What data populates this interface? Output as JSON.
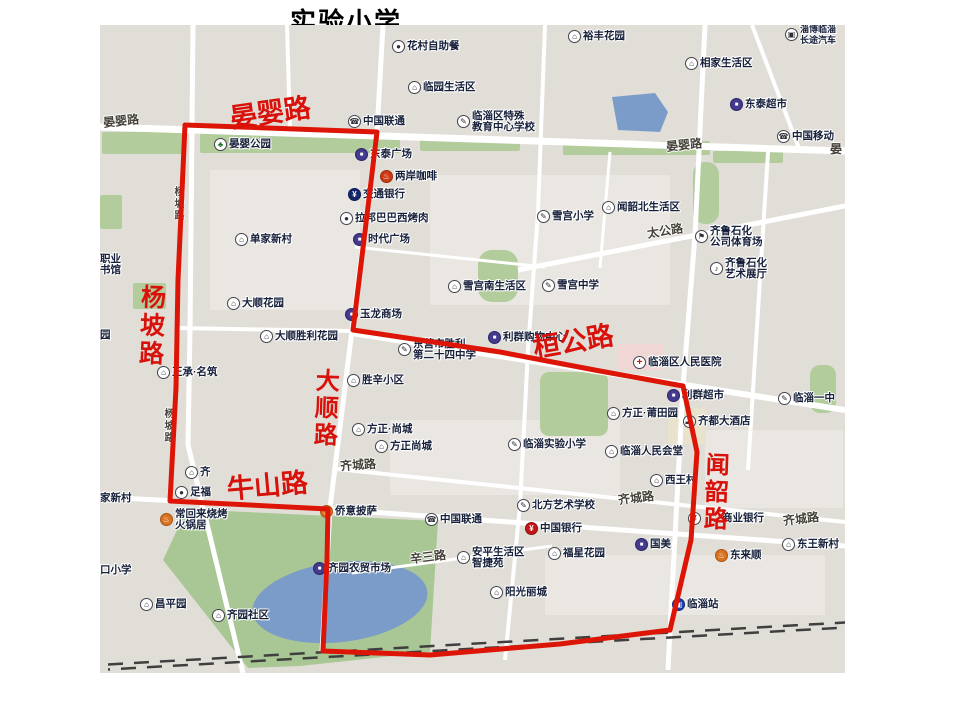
{
  "title": "实验小学",
  "colors": {
    "map_bg": "#e1ded8",
    "block_light": "#eae7e2",
    "road": "#ffffff",
    "green": "#b3cc9c",
    "park_green": "#a9c794",
    "pond_blue": "#7b9cc9",
    "boundary_red": "#dd1506",
    "railway": "#3f3f3f",
    "hospital_block_pink": "#f0d6d4",
    "hotel_block_tan": "#e9e2cd"
  },
  "map": {
    "blocks": [
      {
        "x": 210,
        "y": 170,
        "w": 150,
        "h": 140
      },
      {
        "x": 430,
        "y": 175,
        "w": 240,
        "h": 130
      },
      {
        "x": 390,
        "y": 420,
        "w": 230,
        "h": 75
      },
      {
        "x": 545,
        "y": 555,
        "w": 280,
        "h": 60
      },
      {
        "x": 705,
        "y": 430,
        "w": 138,
        "h": 78
      },
      {
        "x": 618,
        "y": 344,
        "w": 46,
        "h": 26,
        "c": "#f0d6d4"
      },
      {
        "x": 668,
        "y": 408,
        "w": 38,
        "h": 36,
        "c": "#e9e2cd"
      }
    ],
    "greens": [
      {
        "x": 102,
        "y": 132,
        "w": 80,
        "h": 22
      },
      {
        "x": 200,
        "y": 133,
        "w": 200,
        "h": 20
      },
      {
        "x": 420,
        "y": 137,
        "w": 100,
        "h": 14
      },
      {
        "x": 563,
        "y": 141,
        "w": 147,
        "h": 14
      },
      {
        "x": 713,
        "y": 151,
        "w": 70,
        "h": 12
      },
      {
        "x": 693,
        "y": 162,
        "w": 26,
        "h": 62,
        "r": 12
      },
      {
        "x": 478,
        "y": 250,
        "w": 40,
        "h": 52,
        "r": 14
      },
      {
        "x": 540,
        "y": 372,
        "w": 68,
        "h": 64,
        "r": 9
      },
      {
        "x": 810,
        "y": 365,
        "w": 26,
        "h": 48,
        "r": 10
      },
      {
        "x": 100,
        "y": 195,
        "w": 22,
        "h": 34
      },
      {
        "x": 133,
        "y": 283,
        "w": 33,
        "h": 26
      }
    ],
    "park_polygon": [
      [
        203,
        510
      ],
      [
        438,
        521
      ],
      [
        430,
        652
      ],
      [
        300,
        666
      ],
      [
        248,
        668
      ],
      [
        163,
        560
      ],
      [
        185,
        513
      ]
    ],
    "pond": {
      "cx": 340,
      "cy": 602,
      "rx": 88,
      "ry": 40,
      "rot": -7
    },
    "top_pond": [
      [
        612,
        97
      ],
      [
        655,
        93
      ],
      [
        668,
        112
      ],
      [
        660,
        132
      ],
      [
        618,
        130
      ]
    ],
    "roads": [
      {
        "w": 7,
        "pts": [
          [
            100,
            127
          ],
          [
            845,
            151
          ]
        ]
      },
      {
        "w": 4,
        "pts": [
          [
            287,
            25
          ],
          [
            290,
            129
          ]
        ]
      },
      {
        "w": 5,
        "pts": [
          [
            193,
            25
          ],
          [
            190,
            330
          ],
          [
            188,
            445
          ],
          [
            243,
            673
          ]
        ]
      },
      {
        "w": 5,
        "pts": [
          [
            383,
            25
          ],
          [
            377,
            132
          ],
          [
            352,
            330
          ],
          [
            330,
            508
          ],
          [
            322,
            652
          ]
        ]
      },
      {
        "w": 4,
        "pts": [
          [
            545,
            25
          ],
          [
            538,
            212
          ],
          [
            528,
            350
          ],
          [
            520,
            505
          ],
          [
            505,
            660
          ]
        ]
      },
      {
        "w": 5,
        "pts": [
          [
            705,
            25
          ],
          [
            695,
            235
          ],
          [
            683,
            387
          ],
          [
            670,
            630
          ],
          [
            668,
            670
          ]
        ]
      },
      {
        "w": 4,
        "pts": [
          [
            752,
            25
          ],
          [
            800,
            151
          ]
        ]
      },
      {
        "w": 5,
        "pts": [
          [
            518,
            270
          ],
          [
            845,
            206
          ]
        ]
      },
      {
        "w": 4,
        "pts": [
          [
            176,
            328
          ],
          [
            352,
            331
          ]
        ]
      },
      {
        "w": 6,
        "pts": [
          [
            352,
            333
          ],
          [
            845,
            410
          ]
        ]
      },
      {
        "w": 4,
        "pts": [
          [
            337,
            469
          ],
          [
            845,
            522
          ]
        ]
      },
      {
        "w": 5,
        "pts": [
          [
            100,
            497
          ],
          [
            328,
            509
          ],
          [
            845,
            546
          ]
        ]
      },
      {
        "w": 3,
        "pts": [
          [
            352,
            573
          ],
          [
            552,
            546
          ]
        ]
      },
      {
        "w": 3,
        "pts": [
          [
            355,
            247
          ],
          [
            545,
            267
          ]
        ]
      },
      {
        "w": 4,
        "pts": [
          [
            768,
            152
          ],
          [
            748,
            470
          ]
        ]
      },
      {
        "w": 3,
        "pts": [
          [
            610,
            152
          ],
          [
            600,
            268
          ]
        ]
      }
    ],
    "railway": [
      [
        108,
        667
      ],
      [
        845,
        625
      ]
    ],
    "boundary": [
      [
        185,
        125
      ],
      [
        377,
        132
      ],
      [
        363,
        248
      ],
      [
        353,
        330
      ],
      [
        500,
        352
      ],
      [
        600,
        371
      ],
      [
        683,
        386
      ],
      [
        697,
        452
      ],
      [
        691,
        540
      ],
      [
        670,
        630
      ],
      [
        560,
        644
      ],
      [
        430,
        655
      ],
      [
        323,
        651
      ],
      [
        327,
        560
      ],
      [
        328,
        509
      ],
      [
        170,
        501
      ],
      [
        176,
        388
      ],
      [
        178,
        280
      ],
      [
        185,
        125
      ]
    ]
  },
  "red_road_labels": [
    {
      "text": "晏婴路",
      "x": 230,
      "y": 98,
      "size": 27,
      "rot": -8,
      "vert": false
    },
    {
      "text": "杨坡路",
      "x": 136,
      "y": 284,
      "size": 25,
      "rot": 2,
      "vert": true
    },
    {
      "text": "大顺路",
      "x": 310,
      "y": 368,
      "size": 24,
      "rot": 2,
      "vert": true
    },
    {
      "text": "牛山路",
      "x": 227,
      "y": 471,
      "size": 27,
      "rot": -5,
      "vert": false
    },
    {
      "text": "桓公路",
      "x": 533,
      "y": 327,
      "size": 27,
      "rot": -10,
      "vert": false
    },
    {
      "text": "闻韶路",
      "x": 700,
      "y": 452,
      "size": 24,
      "rot": 2,
      "vert": true
    }
  ],
  "black_road_labels": [
    {
      "text": "晏婴路",
      "x": 103,
      "y": 112,
      "size": 12,
      "rot": -6
    },
    {
      "text": "晏婴路",
      "x": 666,
      "y": 136,
      "size": 12,
      "rot": -6
    },
    {
      "text": "晏",
      "x": 830,
      "y": 140,
      "size": 12,
      "rot": 0
    },
    {
      "text": "杨坡路",
      "x": 170,
      "y": 186,
      "size": 10,
      "rot": 0,
      "vert": true
    },
    {
      "text": "杨坡路",
      "x": 160,
      "y": 408,
      "size": 10,
      "rot": 0,
      "vert": true
    },
    {
      "text": "太公路",
      "x": 647,
      "y": 222,
      "size": 12,
      "rot": -9
    },
    {
      "text": "齐城路",
      "x": 340,
      "y": 456,
      "size": 12,
      "rot": -4
    },
    {
      "text": "齐城路",
      "x": 618,
      "y": 489,
      "size": 12,
      "rot": -7
    },
    {
      "text": "齐城路",
      "x": 783,
      "y": 510,
      "size": 12,
      "rot": -7
    },
    {
      "text": "辛三路",
      "x": 410,
      "y": 548,
      "size": 12,
      "rot": -7
    }
  ],
  "pois": [
    {
      "icon": "dot",
      "lines": [
        "花村自助餐"
      ],
      "x": 392,
      "y": 40
    },
    {
      "icon": "estate",
      "lines": [
        "裕丰花园"
      ],
      "x": 568,
      "y": 30
    },
    {
      "icon": "bus",
      "lines": [
        "淄博临淄",
        "长途汽车"
      ],
      "x": 785,
      "y": 28,
      "small": true
    },
    {
      "icon": "estate",
      "lines": [
        "相家生活区"
      ],
      "x": 685,
      "y": 57
    },
    {
      "icon": "estate",
      "lines": [
        "临园生活区"
      ],
      "x": 408,
      "y": 81
    },
    {
      "icon": "mall",
      "lines": [
        "东泰超市"
      ],
      "x": 730,
      "y": 98
    },
    {
      "icon": "telecom",
      "lines": [
        "中国联通"
      ],
      "x": 348,
      "y": 115
    },
    {
      "icon": "school",
      "lines": [
        "临淄区特殊",
        "教育中心学校"
      ],
      "x": 457,
      "y": 115
    },
    {
      "icon": "telecom",
      "lines": [
        "中国移动"
      ],
      "x": 777,
      "y": 130
    },
    {
      "icon": "park",
      "lines": [
        "晏婴公园"
      ],
      "x": 214,
      "y": 138
    },
    {
      "icon": "mall",
      "lines": [
        "东泰广场"
      ],
      "x": 355,
      "y": 148
    },
    {
      "icon": "coffee",
      "lines": [
        "两岸咖啡"
      ],
      "x": 380,
      "y": 170
    },
    {
      "icon": "bank",
      "lines": [
        "交通银行"
      ],
      "x": 348,
      "y": 188
    },
    {
      "icon": "dot",
      "lines": [
        "拉邦巴巴西烤肉"
      ],
      "x": 340,
      "y": 212
    },
    {
      "icon": "mall",
      "lines": [
        "时代广场"
      ],
      "x": 353,
      "y": 233
    },
    {
      "icon": "school",
      "lines": [
        "雪宫小学"
      ],
      "x": 537,
      "y": 210
    },
    {
      "icon": "estate",
      "lines": [
        "闻韶北生活区"
      ],
      "x": 602,
      "y": 201
    },
    {
      "icon": "estate",
      "lines": [
        "单家新村"
      ],
      "x": 235,
      "y": 233
    },
    {
      "icon": "stadium",
      "lines": [
        "齐鲁石化",
        "公司体育场"
      ],
      "x": 695,
      "y": 230
    },
    {
      "icon": "art",
      "lines": [
        "齐鲁石化",
        "艺术展厅"
      ],
      "x": 710,
      "y": 262
    },
    {
      "icon": "estate",
      "lines": [
        "大顺花园"
      ],
      "x": 227,
      "y": 297
    },
    {
      "icon": "estate",
      "lines": [
        "雪宫南生活区"
      ],
      "x": 448,
      "y": 280
    },
    {
      "icon": "school",
      "lines": [
        "雪宫中学"
      ],
      "x": 542,
      "y": 279
    },
    {
      "icon": "mall",
      "lines": [
        "玉龙商场"
      ],
      "x": 345,
      "y": 308
    },
    {
      "icon": "estate",
      "lines": [
        "大顺胜利花园"
      ],
      "x": 260,
      "y": 330
    },
    {
      "icon": "estate",
      "lines": [
        "正承·名筑"
      ],
      "x": 157,
      "y": 366
    },
    {
      "icon": "school",
      "lines": [
        "东营市胜利",
        "第二十四中学"
      ],
      "x": 398,
      "y": 343
    },
    {
      "icon": "mall",
      "lines": [
        "利群购物中心"
      ],
      "x": 488,
      "y": 331
    },
    {
      "icon": "hospital",
      "lines": [
        "临淄区人民医院"
      ],
      "x": 633,
      "y": 356
    },
    {
      "icon": "estate",
      "lines": [
        "胜辛小区"
      ],
      "x": 347,
      "y": 374
    },
    {
      "icon": "mall",
      "lines": [
        "利群超市"
      ],
      "x": 667,
      "y": 389
    },
    {
      "icon": "school",
      "lines": [
        "临淄一中"
      ],
      "x": 778,
      "y": 392
    },
    {
      "icon": "estate",
      "lines": [
        "方正·尚城"
      ],
      "x": 352,
      "y": 423
    },
    {
      "icon": "estate",
      "lines": [
        "方正·莆田园"
      ],
      "x": 607,
      "y": 407
    },
    {
      "icon": "hotel",
      "lines": [
        "齐都大酒店"
      ],
      "x": 683,
      "y": 415
    },
    {
      "icon": "estate",
      "lines": [
        "方正尚城"
      ],
      "x": 375,
      "y": 440
    },
    {
      "icon": "school",
      "lines": [
        "临淄实验小学"
      ],
      "x": 508,
      "y": 438
    },
    {
      "icon": "hall",
      "lines": [
        "临淄人民会堂"
      ],
      "x": 605,
      "y": 445
    },
    {
      "icon": "estate",
      "lines": [
        "西王村"
      ],
      "x": 650,
      "y": 474
    },
    {
      "icon": "estate",
      "lines": [
        "齐"
      ],
      "x": 185,
      "y": 466
    },
    {
      "icon": "dot",
      "lines": [
        "足福"
      ],
      "x": 175,
      "y": 486
    },
    {
      "icon": "orange",
      "lines": [
        "常回来烧烤",
        "火锅居"
      ],
      "x": 160,
      "y": 513
    },
    {
      "icon": "orange",
      "lines": [
        "侨意披萨"
      ],
      "x": 320,
      "y": 505
    },
    {
      "icon": "telecom",
      "lines": [
        "中国联通"
      ],
      "x": 425,
      "y": 513
    },
    {
      "icon": "school",
      "lines": [
        "北方艺术学校"
      ],
      "x": 517,
      "y": 499
    },
    {
      "icon": "boc",
      "lines": [
        "中国银行"
      ],
      "x": 525,
      "y": 522
    },
    {
      "icon": "yen",
      "lines": [
        "商业银行"
      ],
      "x": 688,
      "y": 512,
      "tdx": 34
    },
    {
      "icon": "mall",
      "lines": [
        "国美"
      ],
      "x": 635,
      "y": 538
    },
    {
      "icon": "estate",
      "lines": [
        "东王新村"
      ],
      "x": 782,
      "y": 538
    },
    {
      "icon": "orange",
      "lines": [
        "东来顺"
      ],
      "x": 715,
      "y": 549
    },
    {
      "icon": "estate",
      "lines": [
        "福星花园"
      ],
      "x": 548,
      "y": 547
    },
    {
      "icon": "estate",
      "lines": [
        "安平生活区",
        "智捷苑"
      ],
      "x": 457,
      "y": 551
    },
    {
      "icon": "estate",
      "lines": [
        "阳光丽城"
      ],
      "x": 490,
      "y": 586
    },
    {
      "icon": "mall",
      "lines": [
        "齐园农贸市场"
      ],
      "x": 313,
      "y": 562
    },
    {
      "icon": "train",
      "lines": [
        "临淄站"
      ],
      "x": 672,
      "y": 598
    },
    {
      "icon": "estate",
      "lines": [
        "昌平园"
      ],
      "x": 140,
      "y": 598
    },
    {
      "icon": "estate",
      "lines": [
        "齐园社区"
      ],
      "x": 212,
      "y": 609
    },
    {
      "icon": null,
      "lines": [
        "职业",
        "书馆"
      ],
      "x": 100,
      "y": 258
    },
    {
      "icon": null,
      "lines": [
        "园"
      ],
      "x": 100,
      "y": 329
    },
    {
      "icon": null,
      "lines": [
        "家新村"
      ],
      "x": 100,
      "y": 492
    },
    {
      "icon": null,
      "lines": [
        "口小学"
      ],
      "x": 100,
      "y": 564
    }
  ],
  "icon_glyphs": {
    "estate": "⌂",
    "school": "✎",
    "telecom": "☎",
    "mall": "■",
    "dot": "●",
    "coffee": "♨",
    "orange": "♨",
    "bank": "¥",
    "boc": "¥",
    "yen": "¥",
    "hospital": "+",
    "bus": "▣",
    "train": "▣",
    "park": "♣",
    "stadium": "⚑",
    "art": "♪",
    "hall": "⌂",
    "hotel": "▬"
  }
}
